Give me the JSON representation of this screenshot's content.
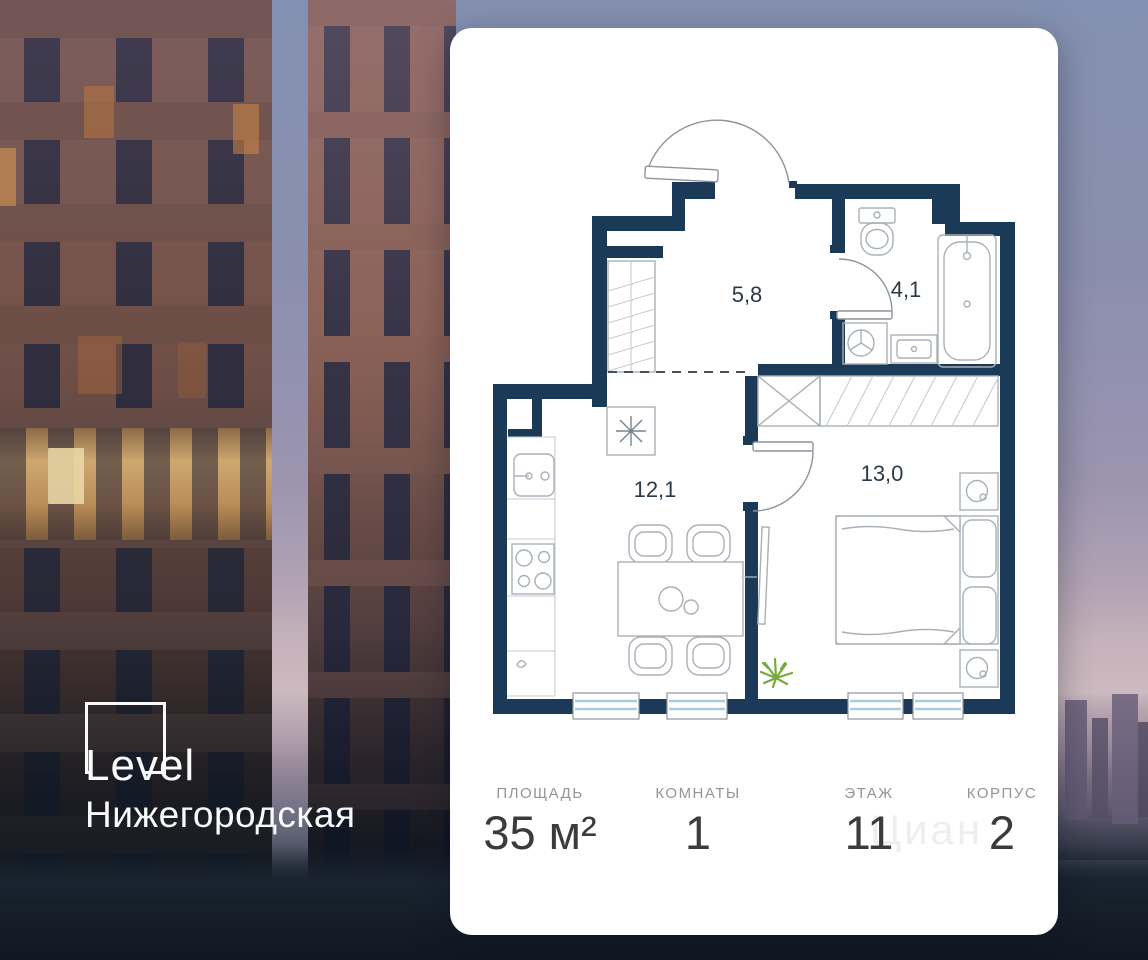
{
  "brand": {
    "name": "Level",
    "project": "Нижегородская"
  },
  "plan": {
    "rooms": [
      {
        "name": "hallway",
        "area_label": "5,8"
      },
      {
        "name": "bathroom",
        "area_label": "4,1"
      },
      {
        "name": "kitchen-living",
        "area_label": "12,1"
      },
      {
        "name": "bedroom",
        "area_label": "13,0"
      }
    ]
  },
  "stats": [
    {
      "label": "ПЛОЩАДЬ",
      "value": "35 м²"
    },
    {
      "label": "КОМНАТЫ",
      "value": "1"
    },
    {
      "label": "ЭТАЖ",
      "value": "11"
    },
    {
      "label": "КОРПУС",
      "value": "2"
    }
  ],
  "watermark": "Циан",
  "colors": {
    "wall": "#1b3a58",
    "glass": "#aac9de",
    "plant": "#76ab3a",
    "card": "#ffffff"
  }
}
